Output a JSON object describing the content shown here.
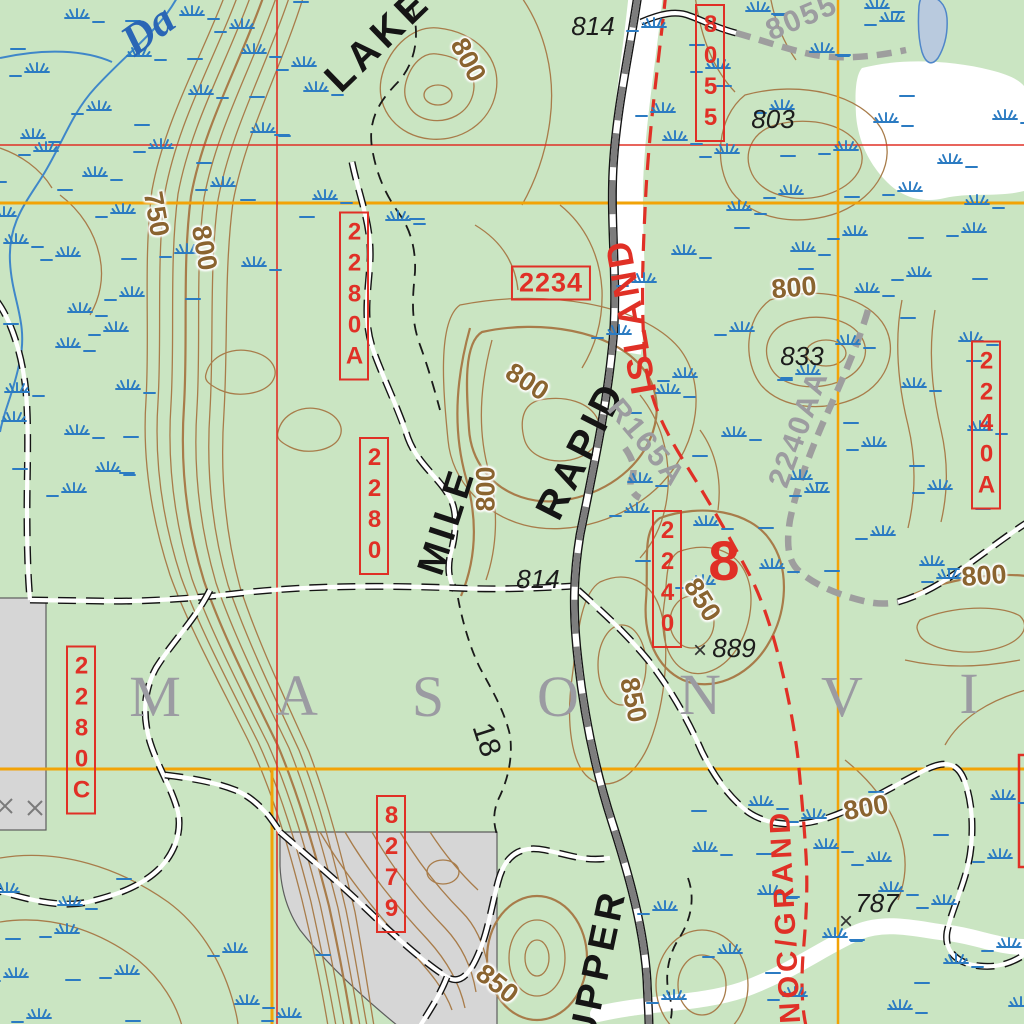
{
  "map": {
    "kind": "USFS-style topographic map tile",
    "town_name_visible": "M A S O N V I",
    "river_name_partial": "Da",
    "section_number": "8",
    "adjacent_section_number": "18"
  },
  "palette": {
    "background_forest_green": "#cae5c2",
    "road_label_red": "#e03026",
    "grid_orange": "#f2a307",
    "contour_brown": "#a87c4a",
    "contour_label_brown": "#8a6430",
    "marsh_blue": "#2b7bc2",
    "stream_blue": "#3f87c9",
    "open_water_fill": "#b9cade",
    "clearing_gray": "#d6d6d6",
    "road_gray_fill": "#7d7d7d",
    "unimproved_road_gray": "#9e9e9e",
    "town_name_gray": "#9b9ba2",
    "river_label_blue": "#2a66b5"
  },
  "labels": [
    {
      "text": "8055",
      "type": "box-v",
      "x": 710,
      "y": 73,
      "fs": 24
    },
    {
      "text": "2234",
      "type": "box-h",
      "x": 551,
      "y": 283,
      "fs": 27
    },
    {
      "text": "2280A",
      "type": "box-v",
      "x": 354,
      "y": 296,
      "fs": 24
    },
    {
      "text": "2280",
      "type": "box-v",
      "x": 374,
      "y": 506,
      "fs": 24
    },
    {
      "text": "2240",
      "type": "box-v",
      "x": 667,
      "y": 579,
      "fs": 24
    },
    {
      "text": "2240A",
      "type": "box-v",
      "x": 986,
      "y": 425,
      "fs": 24
    },
    {
      "text": "2280C",
      "type": "box-v",
      "x": 81,
      "y": 730,
      "fs": 24
    },
    {
      "text": "8279",
      "type": "box-v",
      "x": 391,
      "y": 864,
      "fs": 24
    },
    {
      "text": "LAKE",
      "type": "road-black",
      "x": 378,
      "y": 40,
      "rot": -44,
      "fs": 40
    },
    {
      "text": "RAPID",
      "type": "road-black",
      "x": 581,
      "y": 450,
      "rot": -63,
      "fs": 40
    },
    {
      "text": "MILE",
      "type": "road-black",
      "x": 447,
      "y": 521,
      "rot": -72,
      "fs": 38
    },
    {
      "text": "UPPER",
      "type": "road-black",
      "x": 598,
      "y": 965,
      "rot": -78,
      "fs": 38
    },
    {
      "text": "ISLAND",
      "type": "road-red",
      "x": 631,
      "y": 316,
      "rot": -100,
      "fs": 36
    },
    {
      "text": "NOC/GRAND",
      "type": "road-red",
      "x": 786,
      "y": 916,
      "rot": -93,
      "fs": 29
    },
    {
      "text": "8055",
      "type": "gray",
      "x": 802,
      "y": 18,
      "rot": -23,
      "fs": 30
    },
    {
      "text": "2240AA",
      "type": "gray",
      "x": 799,
      "y": 429,
      "rot": -70,
      "fs": 30
    },
    {
      "text": "R165A",
      "type": "gray",
      "x": 646,
      "y": 443,
      "rot": 50,
      "fs": 30
    },
    {
      "text": "814",
      "type": "spot",
      "x": 593,
      "y": 26,
      "fs": 26
    },
    {
      "text": "803",
      "type": "spot",
      "x": 773,
      "y": 119,
      "fs": 26
    },
    {
      "text": "833",
      "type": "spot",
      "x": 802,
      "y": 356,
      "fs": 26
    },
    {
      "text": "814",
      "type": "spot",
      "x": 538,
      "y": 579,
      "fs": 26
    },
    {
      "text": "889",
      "type": "spot",
      "x": 734,
      "y": 648,
      "fs": 26
    },
    {
      "text": "787",
      "type": "spot",
      "x": 877,
      "y": 903,
      "fs": 26
    },
    {
      "text": "×",
      "type": "spot-x",
      "x": 700,
      "y": 651,
      "fs": 24
    },
    {
      "text": "×",
      "type": "spot-x",
      "x": 846,
      "y": 922,
      "fs": 24
    },
    {
      "text": "750",
      "type": "contour",
      "x": 156,
      "y": 214,
      "rot": 80,
      "fs": 27
    },
    {
      "text": "800",
      "type": "contour",
      "x": 204,
      "y": 248,
      "rot": 80,
      "fs": 27
    },
    {
      "text": "800",
      "type": "contour",
      "x": 468,
      "y": 60,
      "rot": 62,
      "fs": 27
    },
    {
      "text": "800",
      "type": "contour",
      "x": 527,
      "y": 382,
      "rot": 33,
      "fs": 27
    },
    {
      "text": "800",
      "type": "contour",
      "x": 486,
      "y": 489,
      "rot": -90,
      "fs": 27
    },
    {
      "text": "800",
      "type": "contour",
      "x": 794,
      "y": 288,
      "rot": -5,
      "fs": 27
    },
    {
      "text": "800",
      "type": "contour",
      "x": 984,
      "y": 576,
      "rot": -4,
      "fs": 27
    },
    {
      "text": "800",
      "type": "contour",
      "x": 866,
      "y": 808,
      "rot": -10,
      "fs": 27
    },
    {
      "text": "850",
      "type": "contour",
      "x": 702,
      "y": 600,
      "rot": 58,
      "fs": 27
    },
    {
      "text": "850",
      "type": "contour",
      "x": 633,
      "y": 700,
      "rot": 78,
      "fs": 27
    },
    {
      "text": "850",
      "type": "contour",
      "x": 497,
      "y": 984,
      "rot": 38,
      "fs": 27
    },
    {
      "text": "8",
      "type": "section",
      "x": 724,
      "y": 561,
      "fs": 56
    },
    {
      "text": "18",
      "type": "s18",
      "x": 486,
      "y": 740,
      "rot": 72,
      "fs": 30
    },
    {
      "text": "Da",
      "type": "river",
      "x": 148,
      "y": 30,
      "rot": -36,
      "fs": 44
    },
    {
      "text": "M",
      "type": "town",
      "x": 155,
      "y": 697,
      "fs": 58
    },
    {
      "text": "A",
      "type": "town",
      "x": 297,
      "y": 696,
      "fs": 58
    },
    {
      "text": "S",
      "type": "town",
      "x": 428,
      "y": 697,
      "fs": 58
    },
    {
      "text": "O",
      "type": "town",
      "x": 558,
      "y": 697,
      "fs": 58
    },
    {
      "text": "N",
      "type": "town",
      "x": 700,
      "y": 695,
      "fs": 58
    },
    {
      "text": "V",
      "type": "town",
      "x": 842,
      "y": 697,
      "fs": 58
    },
    {
      "text": "I",
      "type": "town",
      "x": 969,
      "y": 694,
      "fs": 58
    }
  ]
}
